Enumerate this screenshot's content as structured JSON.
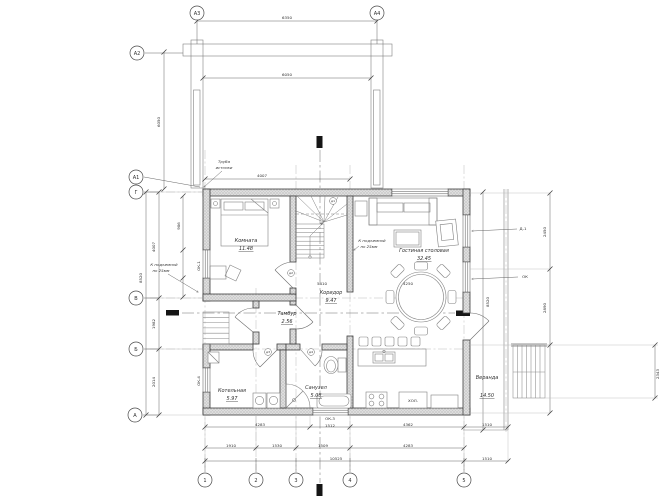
{
  "drawing": {
    "type": "first-floor-plan",
    "language": "ru",
    "paper_color": "#ffffff",
    "line_color": "#3d3d3d"
  },
  "rooms": [
    {
      "name": "Комната",
      "area": "11.48",
      "nx": 246,
      "ny": 242,
      "ax": 246,
      "ay": 250
    },
    {
      "name": "Гостиная столовая",
      "area": "32.45",
      "nx": 424,
      "ny": 252,
      "ax": 424,
      "ay": 260
    },
    {
      "name": "Коридор",
      "area": "9.47",
      "nx": 331,
      "ny": 294,
      "ax": 331,
      "ay": 302
    },
    {
      "name": "Тамбур",
      "area": "2.56",
      "nx": 287,
      "ny": 315,
      "ax": 287,
      "ay": 323
    },
    {
      "name": "Котельная",
      "area": "5.97",
      "nx": 232,
      "ny": 392,
      "ax": 232,
      "ay": 400
    },
    {
      "name": "Санузел",
      "area": "5.08",
      "nx": 316,
      "ny": 389,
      "ax": 316,
      "ay": 397
    },
    {
      "name": "Веранда",
      "area": "14.50",
      "nx": 487,
      "ny": 379,
      "ax": 487,
      "ay": 397
    }
  ],
  "axis_bubbles": [
    {
      "label": "А3",
      "x": 197,
      "y": 13
    },
    {
      "label": "А4",
      "x": 377,
      "y": 13
    },
    {
      "label": "А2",
      "x": 137,
      "y": 53
    },
    {
      "label": "А1",
      "x": 136,
      "y": 177
    },
    {
      "label": "Г",
      "x": 136,
      "y": 192
    },
    {
      "label": "В",
      "x": 136,
      "y": 298
    },
    {
      "label": "Б",
      "x": 136,
      "y": 349
    },
    {
      "label": "А",
      "x": 135,
      "y": 415
    },
    {
      "label": "1",
      "x": 205,
      "y": 480
    },
    {
      "label": "2",
      "x": 256,
      "y": 480
    },
    {
      "label": "3",
      "x": 296,
      "y": 480
    },
    {
      "label": "4",
      "x": 350,
      "y": 480
    },
    {
      "label": "5",
      "x": 464,
      "y": 480
    }
  ],
  "annotations": [
    {
      "t": "6350",
      "x": 287,
      "y": 19
    },
    {
      "t": "6050",
      "x": 287,
      "y": 76
    },
    {
      "t": "6050",
      "x": 160,
      "y": 122,
      "r": -90
    },
    {
      "t": "4007",
      "x": 262,
      "y": 177
    },
    {
      "t": "906",
      "x": 180,
      "y": 226,
      "r": -90
    },
    {
      "t": "4007",
      "x": 155,
      "y": 247,
      "r": -90
    },
    {
      "t": "1982",
      "x": 155,
      "y": 324,
      "r": -90
    },
    {
      "t": "2014",
      "x": 155,
      "y": 382,
      "r": -90
    },
    {
      "t": "8520",
      "x": 142,
      "y": 278,
      "r": -90
    },
    {
      "t": "5410",
      "x": 322,
      "y": 285
    },
    {
      "t": "4250",
      "x": 408,
      "y": 285
    },
    {
      "t": "4283",
      "x": 260,
      "y": 426
    },
    {
      "t": "ОК-3",
      "x": 330,
      "y": 420
    },
    {
      "t": "1512",
      "x": 330,
      "y": 427
    },
    {
      "t": "4362",
      "x": 408,
      "y": 426
    },
    {
      "t": "1510",
      "x": 487,
      "y": 426
    },
    {
      "t": "1910",
      "x": 231,
      "y": 447
    },
    {
      "t": "1530",
      "x": 277,
      "y": 447
    },
    {
      "t": "1509",
      "x": 323,
      "y": 447
    },
    {
      "t": "4283",
      "x": 408,
      "y": 447
    },
    {
      "t": "10525",
      "x": 336,
      "y": 460
    },
    {
      "t": "1510",
      "x": 487,
      "y": 460
    },
    {
      "t": "2450",
      "x": 546,
      "y": 232,
      "r": -90
    },
    {
      "t": "2890",
      "x": 546,
      "y": 308,
      "r": -90
    },
    {
      "t": "8520",
      "x": 489,
      "y": 302,
      "r": -90
    },
    {
      "t": "2343",
      "x": 659,
      "y": 374,
      "r": -90
    },
    {
      "t": "ОК-1",
      "x": 200,
      "y": 266,
      "r": -90
    },
    {
      "t": "ОК-4",
      "x": 200,
      "y": 381,
      "r": -90
    },
    {
      "t": "Д-1",
      "x": 523,
      "y": 230
    },
    {
      "t": "ОК",
      "x": 525,
      "y": 278
    },
    {
      "t": "ХОЛ.",
      "x": 413,
      "y": 402
    }
  ],
  "notes": [
    {
      "t": "Труба",
      "x": 224,
      "y": 163
    },
    {
      "t": "истопки",
      "x": 224,
      "y": 169
    },
    {
      "t": "К подъемной",
      "x": 372,
      "y": 242
    },
    {
      "t": "по 25мм",
      "x": 369,
      "y": 248
    },
    {
      "t": "К подъемной",
      "x": 164,
      "y": 266
    },
    {
      "t": "по 25мм",
      "x": 161,
      "y": 272
    }
  ],
  "door_tags": [
    {
      "t": "д1",
      "x": 333,
      "y": 201
    },
    {
      "t": "д2",
      "x": 291,
      "y": 273
    },
    {
      "t": "д3",
      "x": 268,
      "y": 352
    },
    {
      "t": "д4",
      "x": 311,
      "y": 352
    }
  ]
}
